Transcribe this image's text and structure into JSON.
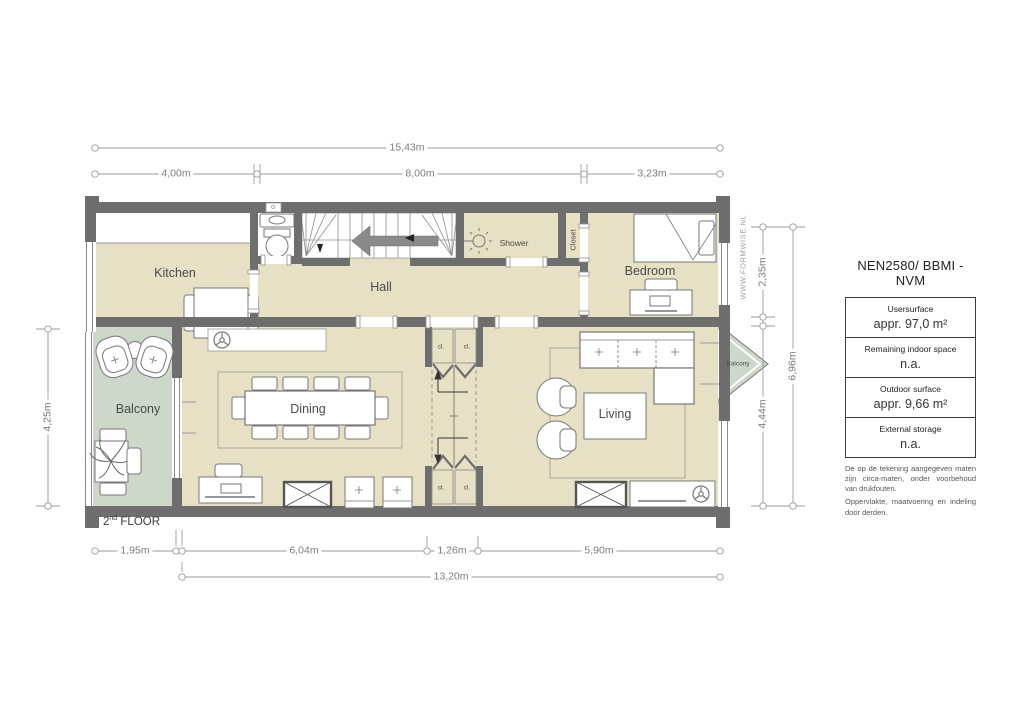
{
  "watermark": "WWW.FORMWISE.NL",
  "floor_label": {
    "num": "2",
    "sup": "nd",
    "rest": " FLOOR"
  },
  "dims": {
    "top_total": "15,43m",
    "top_segments": [
      "4,00m",
      "8,00m",
      "3,23m"
    ],
    "left": "4,25m",
    "right_segments": [
      "2,35m",
      "4,44m"
    ],
    "right_total": "6,96m",
    "bottom_segments": [
      "1,95m",
      "6,04m",
      "1,26m",
      "5,90m"
    ],
    "bottom_total": "13,20m"
  },
  "rooms": {
    "kitchen": "Kitchen",
    "hall": "Hall",
    "shower": "Shower",
    "closet": "Closet",
    "bedroom": "Bedroom",
    "balcony_left": "Balcony",
    "balcony_right": "Balcony",
    "dining": "Dining",
    "living": "Living",
    "cl": "cl."
  },
  "legend": {
    "title": "NEN2580/ BBMI - NVM",
    "rows": [
      {
        "label": "Usersurface",
        "value": "appr. 97,0 m²"
      },
      {
        "label": "Remaining indoor space",
        "value": "n.a."
      },
      {
        "label": "Outdoor surface",
        "value": "appr. 9,66 m²"
      },
      {
        "label": "External storage",
        "value": "n.a."
      }
    ],
    "disclaimer1": "De op de tekening aangegeven maten zijn circa-maten, onder voorbehoud van drukfouten.",
    "disclaimer2": "Oppervlakte, maatvoering en indeling door derden."
  }
}
